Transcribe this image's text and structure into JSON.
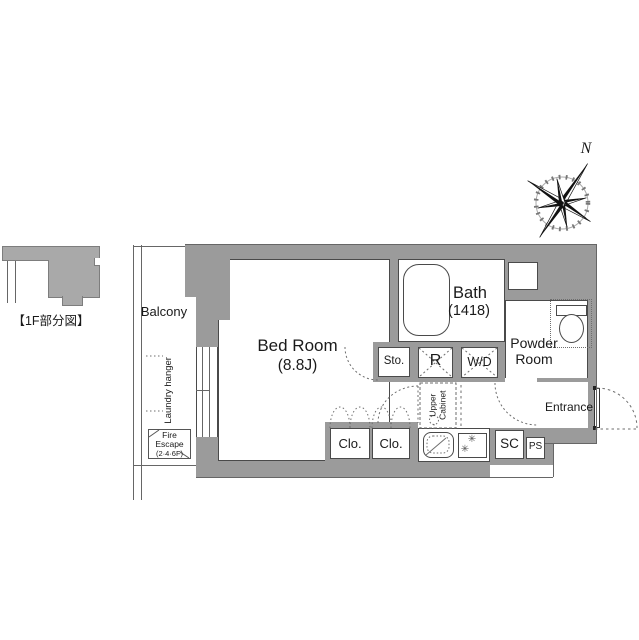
{
  "mini_figure": {
    "label": "【1F部分図】"
  },
  "compass": {
    "north": "N"
  },
  "balcony": {
    "label": "Balcony",
    "laundry": "Laundry hanger",
    "fire_escape": [
      "Fire",
      "Escape",
      "(2·4·6F)"
    ]
  },
  "rooms": {
    "bedroom": {
      "name": "Bed Room",
      "size": "(8.8J)"
    },
    "bath": {
      "name": "Bath",
      "size": "(1418)"
    },
    "powder_room": {
      "line1": "Powder",
      "line2": "Room"
    },
    "entrance": {
      "name": "Entrance"
    }
  },
  "storage": {
    "sto": "Sto.",
    "refrigerator": "R",
    "washer_dryer": "W/D",
    "upper_cabinet": [
      "Upper",
      "Cabinet"
    ],
    "closet_1": "Clo.",
    "closet_2": "Clo.",
    "shoe_closet": "SC",
    "pipe_space": "PS"
  },
  "kitchen": {
    "burner_icon": "✳"
  },
  "colors": {
    "wall": "#9b9b9b",
    "mini_wall": "#a9a9a9",
    "line": "#4a4a4a"
  }
}
